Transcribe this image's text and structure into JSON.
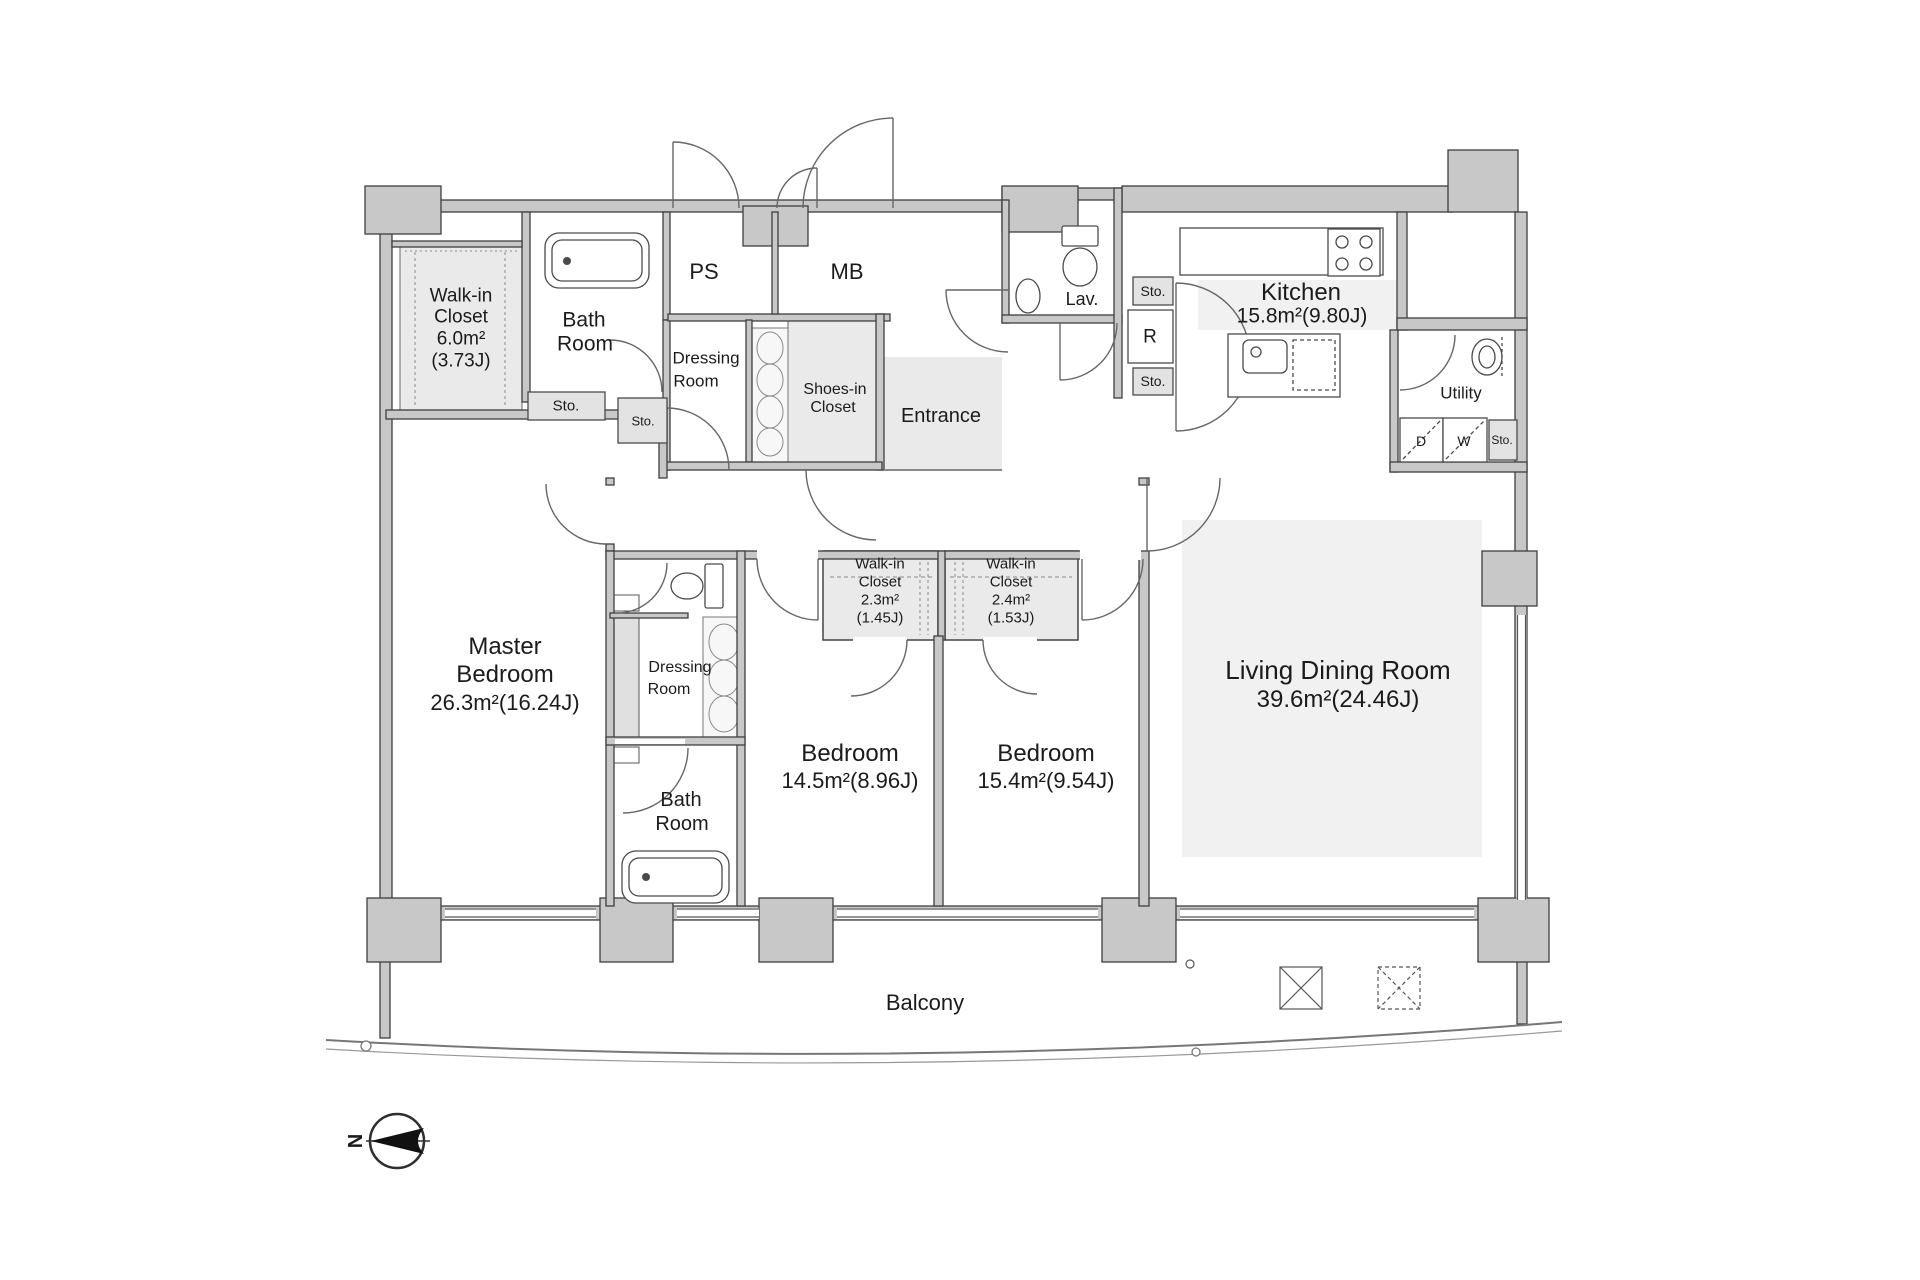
{
  "compass": {
    "north": "N"
  },
  "labels": {
    "sto": "Sto.",
    "ps": "PS",
    "mb": "MB",
    "r": "R",
    "d": "D",
    "w": "W",
    "lav": "Lav.",
    "utility": "Utility",
    "entrance": "Entrance",
    "balcony": "Balcony"
  },
  "rooms": {
    "walk_in_closet_main": {
      "line1": "Walk-in",
      "line2": "Closet",
      "area": "6.0m²",
      "tatami": "(3.73J)"
    },
    "bath_room_main": {
      "line1": "Bath",
      "line2": "Room"
    },
    "dressing_room_top": {
      "line1": "Dressing",
      "line2": "Room"
    },
    "shoes_in_closet": {
      "line1": "Shoes-in",
      "line2": "Closet"
    },
    "kitchen": {
      "name": "Kitchen",
      "area": "15.8m²(9.80J)"
    },
    "master_bedroom": {
      "line1": "Master",
      "line2": "Bedroom",
      "area": "26.3m²(16.24J)"
    },
    "dressing_room_mid": {
      "line1": "Dressing",
      "line2": "Room"
    },
    "bath_room_mid": {
      "line1": "Bath",
      "line2": "Room"
    },
    "walk_in_closet_2": {
      "line1": "Walk-in",
      "line2": "Closet",
      "area": "2.3m²",
      "tatami": "(1.45J)"
    },
    "walk_in_closet_3": {
      "line1": "Walk-in",
      "line2": "Closet",
      "area": "2.4m²",
      "tatami": "(1.53J)"
    },
    "bedroom_1": {
      "name": "Bedroom",
      "area": "14.5m²(8.96J)"
    },
    "bedroom_2": {
      "name": "Bedroom",
      "area": "15.4m²(9.54J)"
    },
    "living_dining": {
      "name": "Living Dining Room",
      "area": "39.6m²(24.46J)"
    }
  }
}
